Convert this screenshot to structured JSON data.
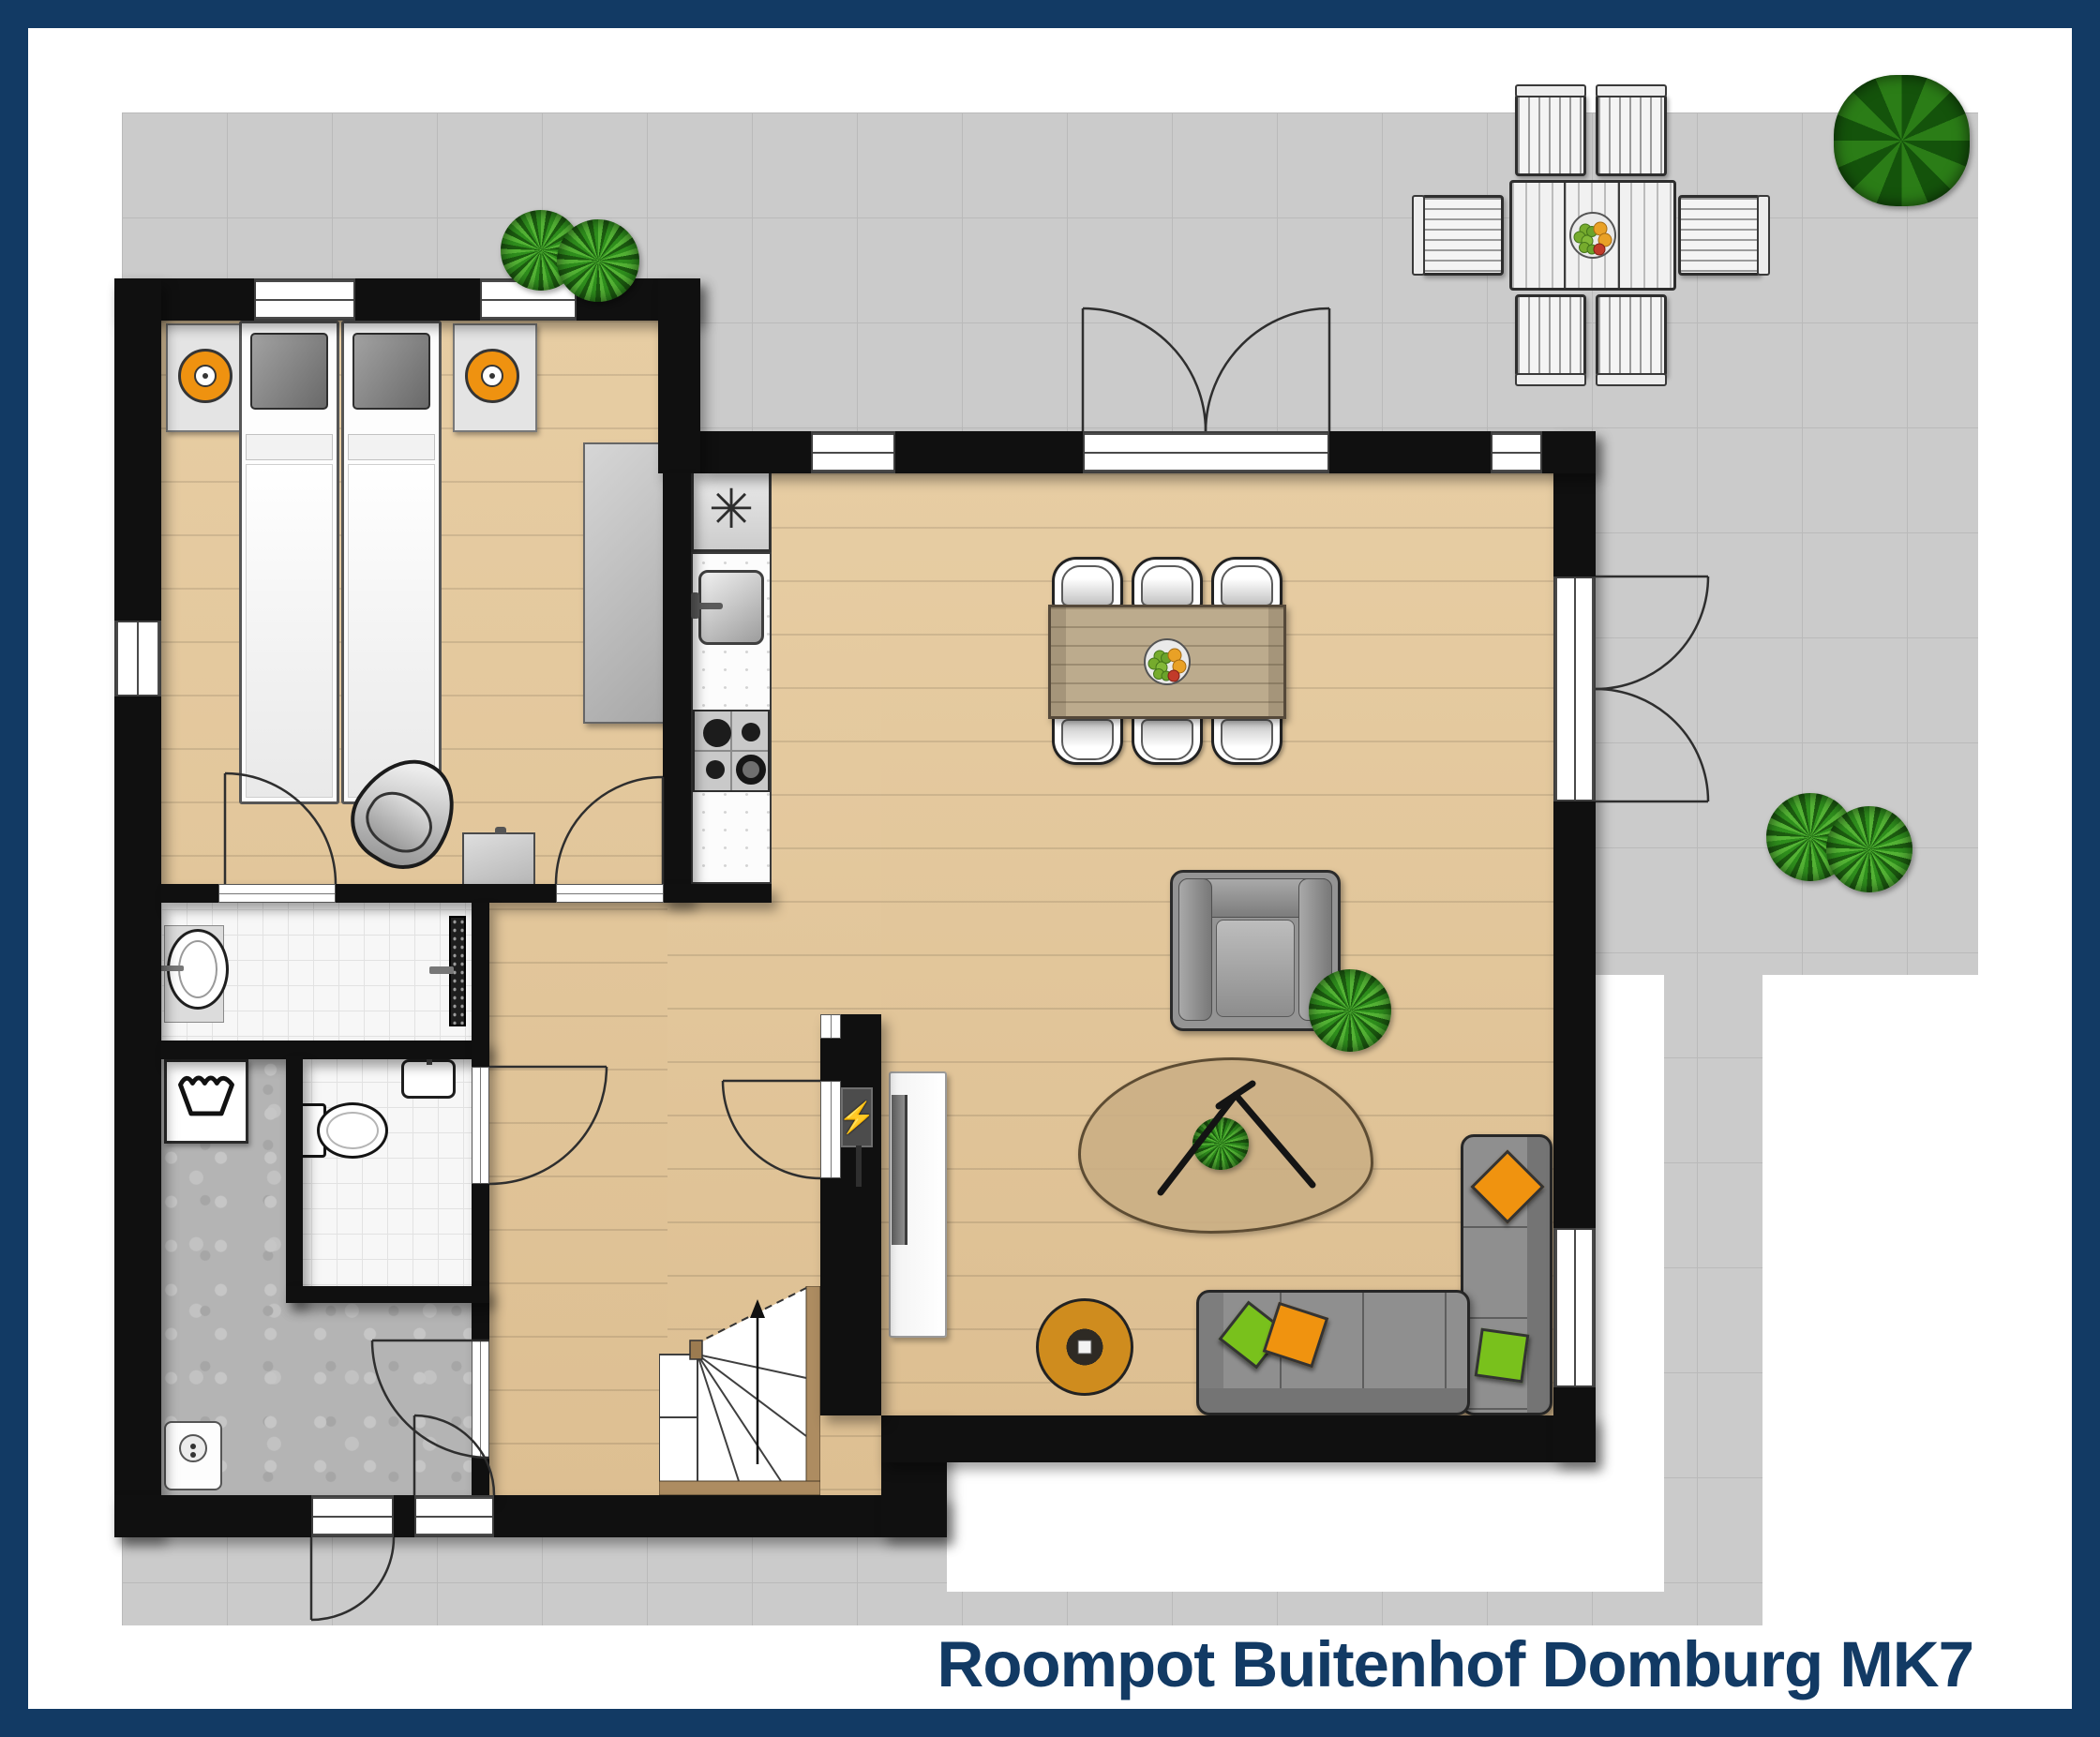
{
  "title": "Roompot Buitenhof Domburg MK7",
  "glyphs": {
    "freezer_symbol": "✳",
    "power_symbol": "⚡"
  },
  "palette": {
    "frame_navy": "#123a64",
    "terrace_gray": "#cbcbcb",
    "wall_black": "#101010",
    "wood_floor": "#e2c79c",
    "table_wood": "#b5a386",
    "tile_white": "#f7f7f7",
    "utility_gray": "#b4b4b4",
    "accent_orange": "#ef9210",
    "accent_green": "#79c11c",
    "plant_green": "#2f8f1d",
    "sofa_gray": "#8f8f8f"
  },
  "floor_plan": {
    "type": "ground-floor holiday home plan, top-down view",
    "rooms": [
      {
        "name": "bedroom",
        "fixtures": [
          "single-bed",
          "single-bed",
          "nightstand-with-lamp",
          "nightstand-with-lamp",
          "wardrobe",
          "desk",
          "desk-chair"
        ],
        "windows": 3
      },
      {
        "name": "bathroom",
        "fixtures": [
          "washbasin",
          "walk-in-shower"
        ]
      },
      {
        "name": "toilet-room",
        "fixtures": [
          "toilet",
          "hand-basin"
        ]
      },
      {
        "name": "utility-room",
        "fixtures": [
          "washing-machine",
          "boiler"
        ],
        "exterior_door": true
      },
      {
        "name": "hall",
        "fixtures": [
          "winder-staircase",
          "meter-cupboard"
        ],
        "front_door": true
      },
      {
        "name": "kitchen",
        "fixtures": [
          "freezer",
          "sink-unit",
          "gas-hob-4-burners",
          "worktop"
        ]
      },
      {
        "name": "living-dining-room",
        "fixtures": [
          "dining-table",
          "dining-chairs-x6",
          "fruit-bowl",
          "armchair",
          "rug-with-decor",
          "corner-sofa",
          "cushions-x4",
          "round-side-table",
          "tv-unit",
          "plant"
        ],
        "french_doors": 2
      }
    ],
    "outdoor": {
      "terrace": [
        "outdoor-dining-table",
        "outdoor-chairs-x6",
        "fruit-bowl",
        "plants-x5",
        "garden-path"
      ]
    }
  }
}
